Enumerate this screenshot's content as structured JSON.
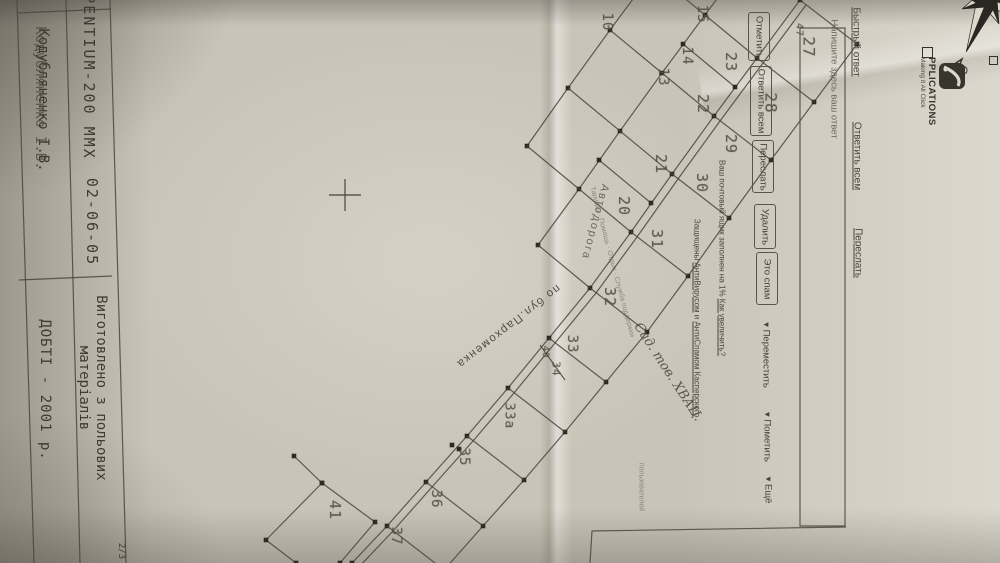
{
  "page": {
    "indicator": "2/3"
  },
  "title_block": {
    "machine": "PENTIUM-200 MMX",
    "date": "02-06-05",
    "signature": "Кодубляненко І.В.",
    "made_of_line1": "Виготовлено з польових",
    "made_of_line2": "матеріалів",
    "org_year": "ДОБТІ - 2001 р."
  },
  "compass": {
    "north_label": "С"
  },
  "logo": {
    "name": "PPLICATIONS",
    "tagline": "Making it All Click"
  },
  "mail_ui": {
    "quick_links": [
      {
        "label": "Быстрый ответ",
        "x": 856,
        "y": 42
      },
      {
        "label": "Ответить всем",
        "x": 857,
        "y": 156
      },
      {
        "label": "Переслать",
        "x": 858,
        "y": 253
      }
    ],
    "reply_placeholder": "Напишите здесь ваш ответ",
    "toolbar_buttons": [
      {
        "label": "Отметить",
        "x": 748,
        "y": 12,
        "h": 47
      },
      {
        "label": "Ответить всем",
        "x": 750,
        "y": 66,
        "h": 68
      },
      {
        "label": "Переслать",
        "x": 752,
        "y": 140,
        "h": 51
      },
      {
        "label": "Удалить",
        "x": 754,
        "y": 204,
        "h": 43
      },
      {
        "label": "Это спам",
        "x": 756,
        "y": 252,
        "h": 51
      }
    ],
    "dropdowns": [
      {
        "label": "Переместить",
        "x": 766,
        "y": 355
      },
      {
        "label": "Пометить",
        "x": 767,
        "y": 437
      },
      {
        "label": "Ещё",
        "x": 768,
        "y": 490
      }
    ],
    "quota_prefix": "Ваш почтовый ящик заполнен на 1% ",
    "quota_link": "Как увеличить?",
    "av_prefix": "Защищены ",
    "av_link1": "АнтиВирусом",
    "av_mid": " и ",
    "av_link2": "АнтиСпамом Касперского",
    "footer_links": "Тарифы · Помощь · Отдых · Служба поддержки",
    "footer_links2": "пользователей"
  },
  "map": {
    "street_label_1": "Автодорога",
    "street_label_2": "по бул.Пархоменка",
    "area_label": "Сад. тов. ХВАЦ.",
    "plots": [
      {
        "n": "10",
        "x": 607,
        "y": 22,
        "s": 14
      },
      {
        "n": "15",
        "x": 702,
        "y": 14,
        "s": 14
      },
      {
        "n": "14",
        "x": 687,
        "y": 56,
        "s": 14
      },
      {
        "n": "13",
        "x": 663,
        "y": 77,
        "s": 14
      },
      {
        "n": "23",
        "x": 731,
        "y": 62,
        "s": 15
      },
      {
        "n": "22",
        "x": 703,
        "y": 104,
        "s": 15
      },
      {
        "n": "47",
        "x": 799,
        "y": 30,
        "s": 10
      },
      {
        "n": "27",
        "x": 809,
        "y": 47,
        "s": 16
      },
      {
        "n": "28",
        "x": 771,
        "y": 103,
        "s": 16
      },
      {
        "n": "29",
        "x": 731,
        "y": 144,
        "s": 15
      },
      {
        "n": "30",
        "x": 702,
        "y": 183,
        "s": 15
      },
      {
        "n": "21",
        "x": 661,
        "y": 164,
        "s": 15
      },
      {
        "n": "20",
        "x": 624,
        "y": 206,
        "s": 15
      },
      {
        "n": "31",
        "x": 657,
        "y": 239,
        "s": 15
      },
      {
        "n": "32",
        "x": 610,
        "y": 297,
        "s": 15
      },
      {
        "n": "33",
        "x": 572,
        "y": 344,
        "s": 14
      },
      {
        "n": "40",
        "x": 545,
        "y": 352,
        "s": 9
      },
      {
        "n": "34",
        "x": 556,
        "y": 369,
        "s": 11
      },
      {
        "n": "33а",
        "x": 509,
        "y": 416,
        "s": 13
      },
      {
        "n": "35",
        "x": 464,
        "y": 457,
        "s": 14
      },
      {
        "n": "36",
        "x": 436,
        "y": 499,
        "s": 14
      },
      {
        "n": "37",
        "x": 396,
        "y": 536,
        "s": 14
      },
      {
        "n": "41",
        "x": 335,
        "y": 510,
        "s": 15
      }
    ]
  },
  "geometry": {
    "polylines": [
      {
        "pts": [
          [
            800,
            0
          ],
          [
            757,
            58
          ],
          [
            714,
            116
          ],
          [
            672,
            174
          ],
          [
            631,
            232
          ],
          [
            590,
            288
          ],
          [
            549,
            338
          ],
          [
            508,
            388
          ],
          [
            467,
            436
          ],
          [
            426,
            482
          ],
          [
            387,
            526
          ],
          [
            352,
            563
          ]
        ],
        "dots": true
      },
      {
        "pts": [
          [
            806,
            5
          ],
          [
            763,
            63
          ],
          [
            720,
            121
          ],
          [
            678,
            179
          ],
          [
            637,
            237
          ],
          [
            596,
            293
          ],
          [
            555,
            343
          ],
          [
            514,
            393
          ],
          [
            473,
            441
          ],
          [
            432,
            487
          ],
          [
            393,
            531
          ],
          [
            358,
            568
          ]
        ],
        "dots": false
      },
      {
        "pts": [
          [
            857,
            44
          ],
          [
            814,
            102
          ],
          [
            771,
            160
          ],
          [
            729,
            218
          ],
          [
            688,
            276
          ],
          [
            647,
            332
          ],
          [
            606,
            382
          ],
          [
            565,
            432
          ],
          [
            524,
            480
          ],
          [
            483,
            526
          ],
          [
            444,
            570
          ]
        ],
        "dots": true
      },
      {
        "pts": [
          [
            748,
            -43
          ],
          [
            705,
            15
          ],
          [
            662,
            73
          ],
          [
            620,
            131
          ],
          [
            579,
            189
          ],
          [
            538,
            245
          ]
        ],
        "dots": true
      },
      {
        "pts": [
          [
            653,
            -28
          ],
          [
            610,
            30
          ],
          [
            568,
            88
          ],
          [
            527,
            146
          ]
        ],
        "dots": true
      },
      {
        "pts": [
          [
            294,
            456
          ],
          [
            322,
            483
          ],
          [
            375,
            522
          ],
          [
            340,
            563
          ]
        ],
        "dots": true
      },
      {
        "pts": [
          [
            322,
            483
          ],
          [
            266,
            540
          ],
          [
            296,
            563
          ]
        ],
        "dots": true
      },
      {
        "pts": [
          [
            846,
            527
          ],
          [
            592,
            531
          ],
          [
            590,
            563
          ]
        ],
        "dots": false
      },
      {
        "pts": [
          [
            800,
            28
          ],
          [
            845,
            28
          ],
          [
            845,
            526
          ],
          [
            800,
            526
          ],
          [
            800,
            28
          ]
        ],
        "dots": false
      },
      {
        "pts": [
          [
            17,
            0
          ],
          [
            34,
            563
          ]
        ],
        "dots": false
      },
      {
        "pts": [
          [
            66,
            0
          ],
          [
            80,
            563
          ]
        ],
        "dots": false
      },
      {
        "pts": [
          [
            110,
            0
          ],
          [
            126,
            563
          ]
        ],
        "dots": false
      },
      {
        "pts": [
          [
            17,
            13
          ],
          [
            111,
            9
          ]
        ],
        "dots": false
      },
      {
        "pts": [
          [
            19,
            280
          ],
          [
            112,
            276
          ]
        ],
        "dots": false
      }
    ],
    "ties": [
      [
        800,
        0,
        857,
        44
      ],
      [
        757,
        58,
        814,
        102
      ],
      [
        714,
        116,
        771,
        160
      ],
      [
        672,
        174,
        729,
        218
      ],
      [
        631,
        232,
        688,
        276
      ],
      [
        590,
        288,
        647,
        332
      ],
      [
        549,
        338,
        606,
        382
      ],
      [
        508,
        388,
        565,
        432
      ],
      [
        467,
        436,
        524,
        480
      ],
      [
        426,
        482,
        483,
        526
      ],
      [
        387,
        526,
        444,
        570
      ],
      [
        800,
        0,
        748,
        -43
      ],
      [
        757,
        58,
        705,
        15
      ],
      [
        735,
        87,
        683,
        44
      ],
      [
        714,
        116,
        662,
        73
      ],
      [
        672,
        174,
        620,
        131
      ],
      [
        651,
        203,
        599,
        160
      ],
      [
        631,
        232,
        579,
        189
      ],
      [
        590,
        288,
        538,
        245
      ],
      [
        705,
        15,
        653,
        -28
      ],
      [
        662,
        73,
        610,
        30
      ],
      [
        620,
        131,
        568,
        88
      ],
      [
        579,
        189,
        527,
        146
      ],
      [
        540,
        345,
        565,
        380
      ]
    ],
    "extra_dots": [
      [
        735,
        87
      ],
      [
        683,
        44
      ],
      [
        651,
        203
      ],
      [
        599,
        160
      ],
      [
        452,
        445
      ],
      [
        459,
        449
      ]
    ],
    "cross": [
      345,
      195
    ]
  }
}
